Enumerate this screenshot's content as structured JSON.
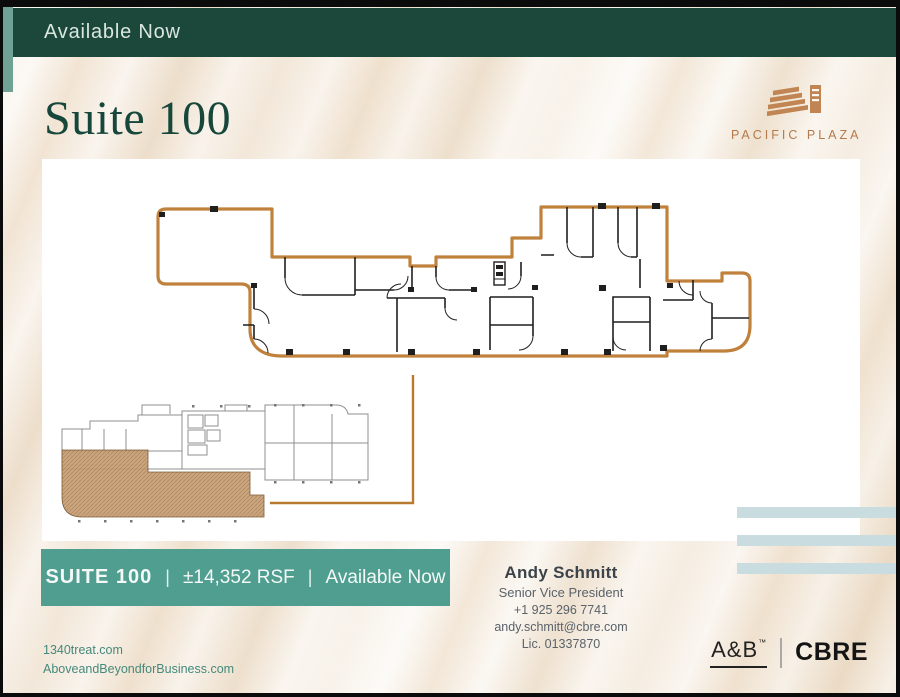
{
  "header": {
    "banner_label": "Available Now",
    "bg": "#1c473b",
    "accent": "#6fa295"
  },
  "title": {
    "text": "Suite 100",
    "color": "#17463a"
  },
  "brand": {
    "name": "PACIFIC PLAZA",
    "color": "#b5794b",
    "icon": "building-icon"
  },
  "floorplan": {
    "outline_color": "#c0813c",
    "keyplan_suite_fill": "#c79d72"
  },
  "stripes": {
    "color": "#c9dde1"
  },
  "infobar": {
    "bg": "#4f9e90",
    "suite": "SUITE 100",
    "separator": "|",
    "size": "±14,352 RSF",
    "availability": "Available Now"
  },
  "contact": {
    "name": "Andy Schmitt",
    "role": "Senior Vice President",
    "phone": "+1 925 296 7741",
    "email": "andy.schmitt@cbre.com",
    "license": "Lic. 01337870"
  },
  "links": {
    "site1": "1340treat.com",
    "site2": "AboveandBeyondforBusiness.com"
  },
  "logos": {
    "ab": "A&B",
    "ab_tm": "™",
    "cbre": "CBRE"
  }
}
